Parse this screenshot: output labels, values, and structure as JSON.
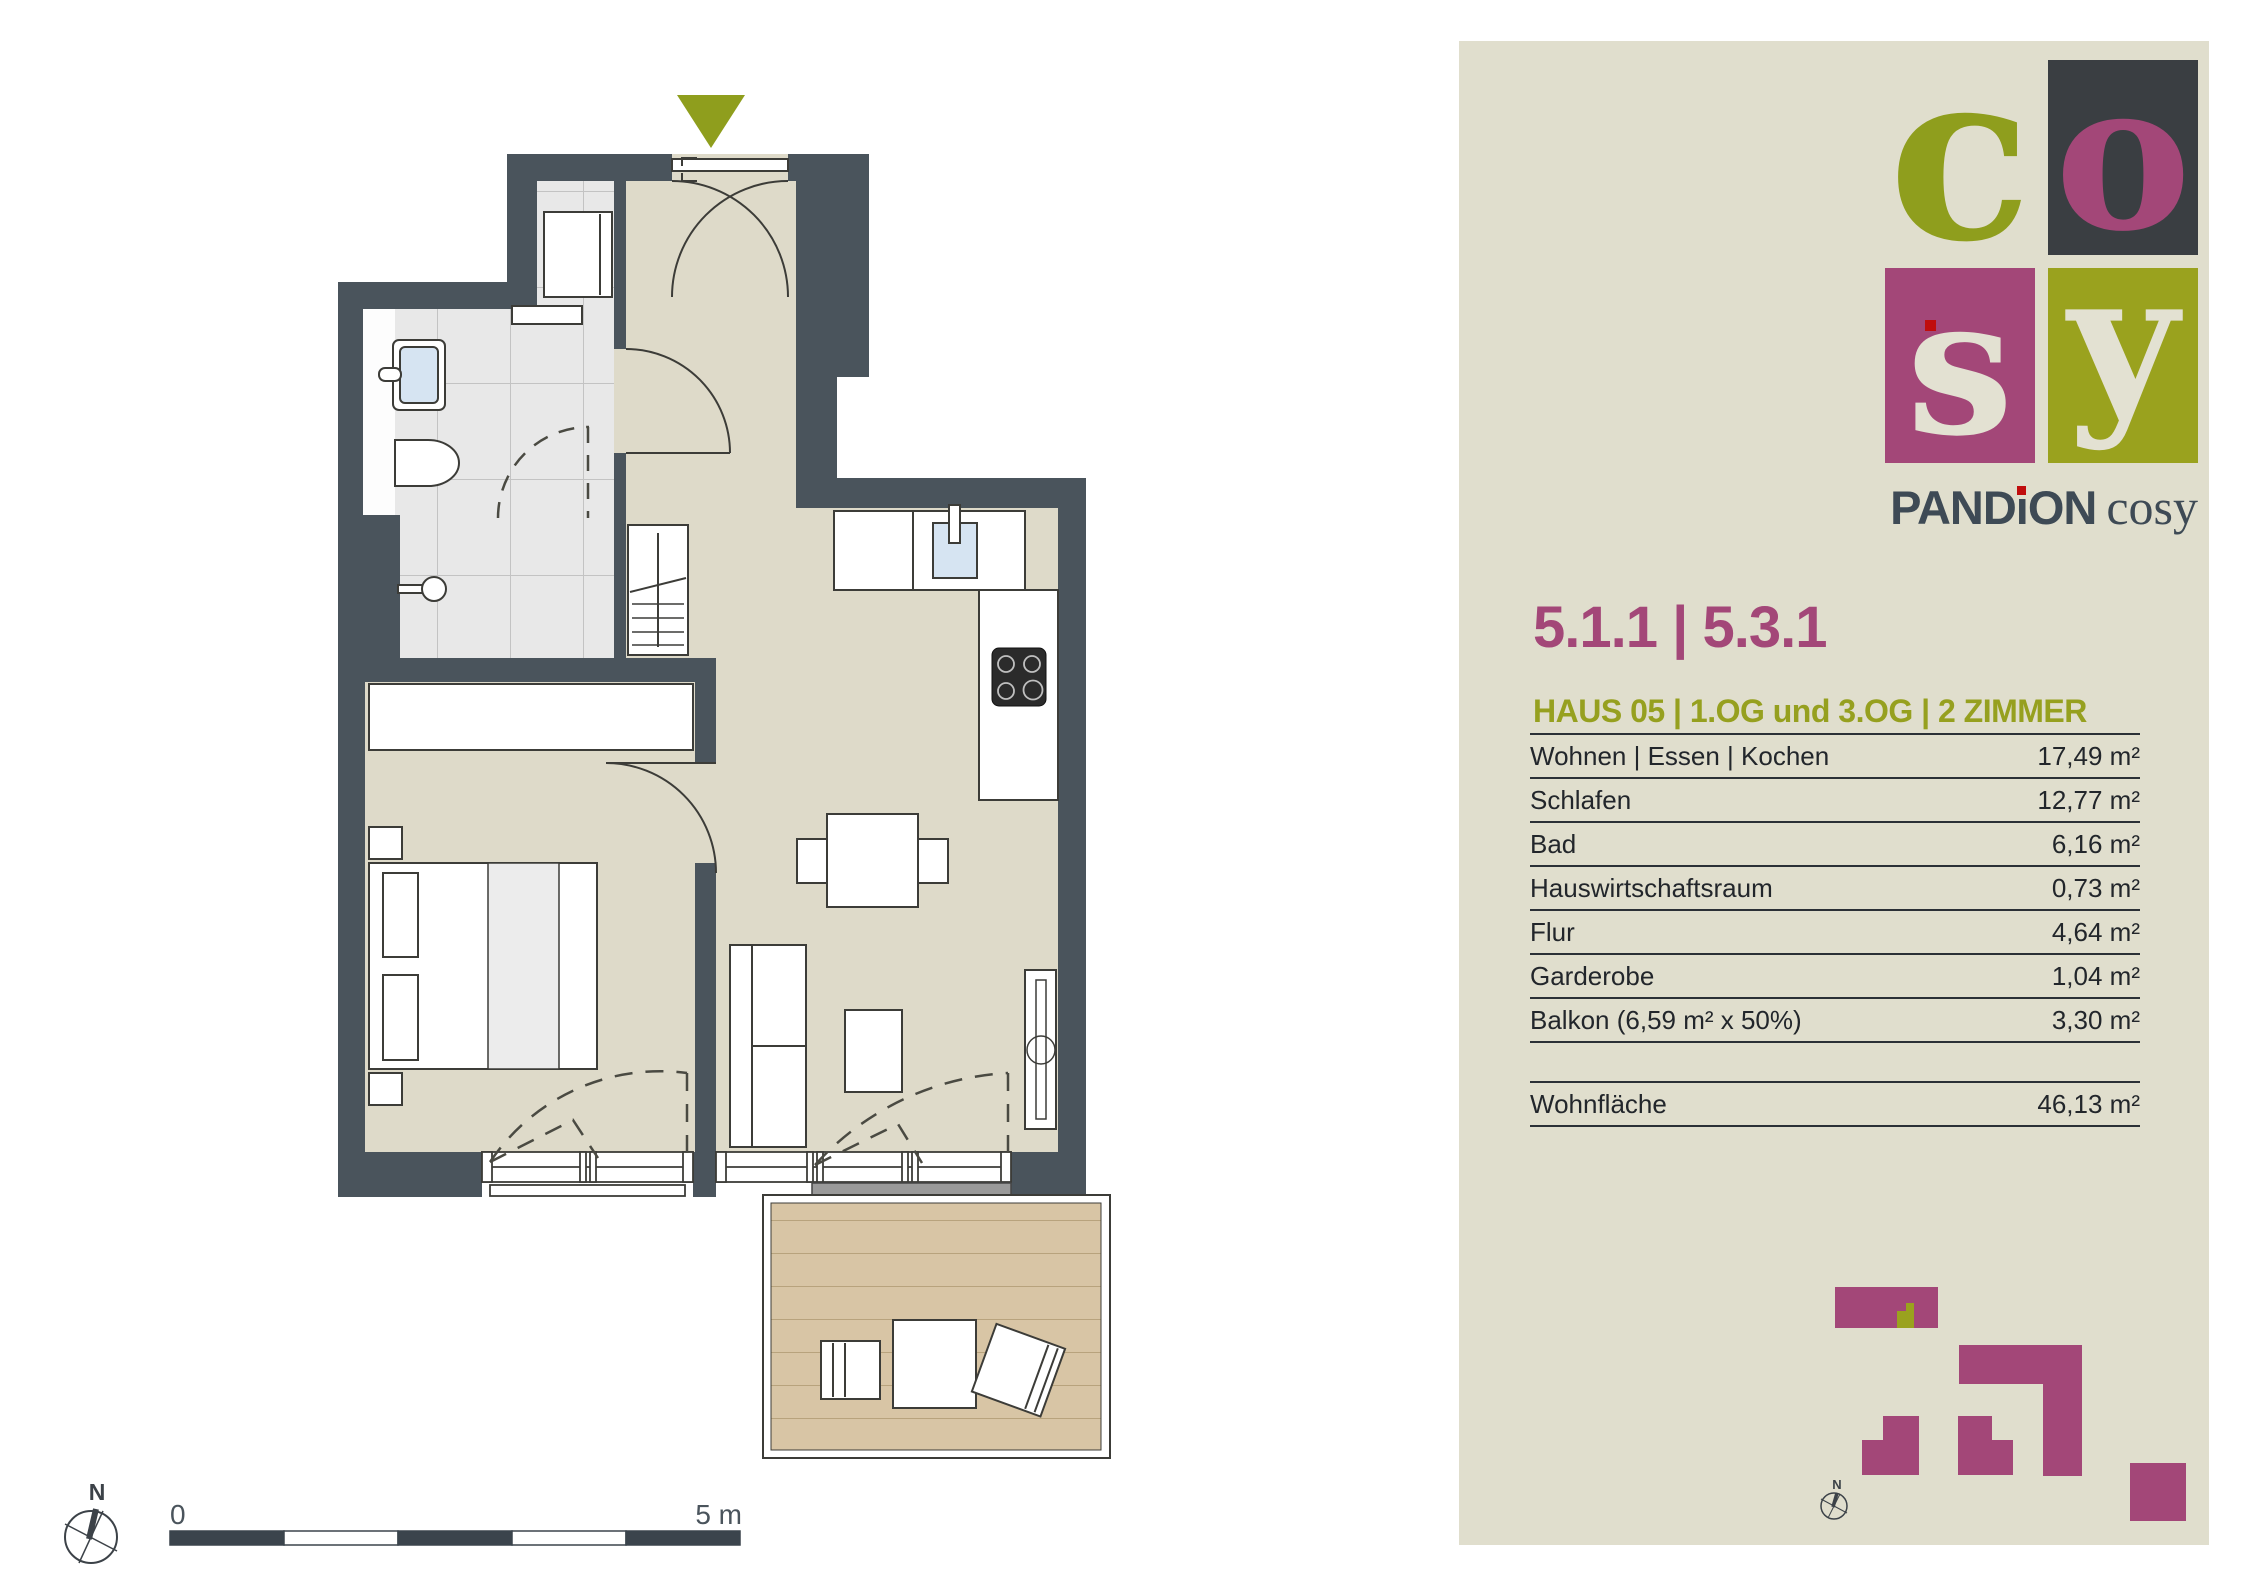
{
  "panel": {
    "background": "#E0DECD",
    "brand": {
      "logo_letters": {
        "c": "c",
        "o": "o",
        "s": "s",
        "y": "y"
      },
      "wordmark_parts": {
        "p1": "PAND",
        "p2": "i",
        "p3": "ON"
      },
      "wordmark_suffix": "cosy"
    },
    "title": "5.1.1 | 5.3.1",
    "subtitle": "HAUS 05 | 1.OG und 3.OG | 2 ZIMMER",
    "table": {
      "rows": [
        {
          "label": "Wohnen | Essen | Kochen",
          "value": "17,49 m²"
        },
        {
          "label": "Schlafen",
          "value": "12,77 m²"
        },
        {
          "label": "Bad",
          "value": "6,16 m²"
        },
        {
          "label": "Hauswirtschaftsraum",
          "value": "0,73 m²"
        },
        {
          "label": "Flur",
          "value": "4,64 m²"
        },
        {
          "label": "Garderobe",
          "value": "1,04 m²"
        },
        {
          "label": "Balkon (6,59 m² x 50%)",
          "value": "3,30 m²"
        }
      ],
      "total": {
        "label": "Wohnfläche",
        "value": "46,13 m²"
      }
    }
  },
  "floorplan": {
    "north_label": "N",
    "scale": {
      "start_label": "0",
      "end_label": "5 m"
    }
  },
  "site_plan": {
    "north_label": "N"
  },
  "colors": {
    "wall": "#4A545C",
    "floor": "#DEDAC9",
    "tile_floor": "#E8E8E8",
    "balcony_deck": "#D8C5A5",
    "accent_magenta": "#A34778",
    "accent_olive": "#8F9E1D",
    "panel_background": "#E0DECD",
    "logo_dark_box": "#3A3E42",
    "brand_slate": "#3E4A55",
    "brand_red_dot": "#C00D0D",
    "sink_blue": "#D6E4F2"
  }
}
